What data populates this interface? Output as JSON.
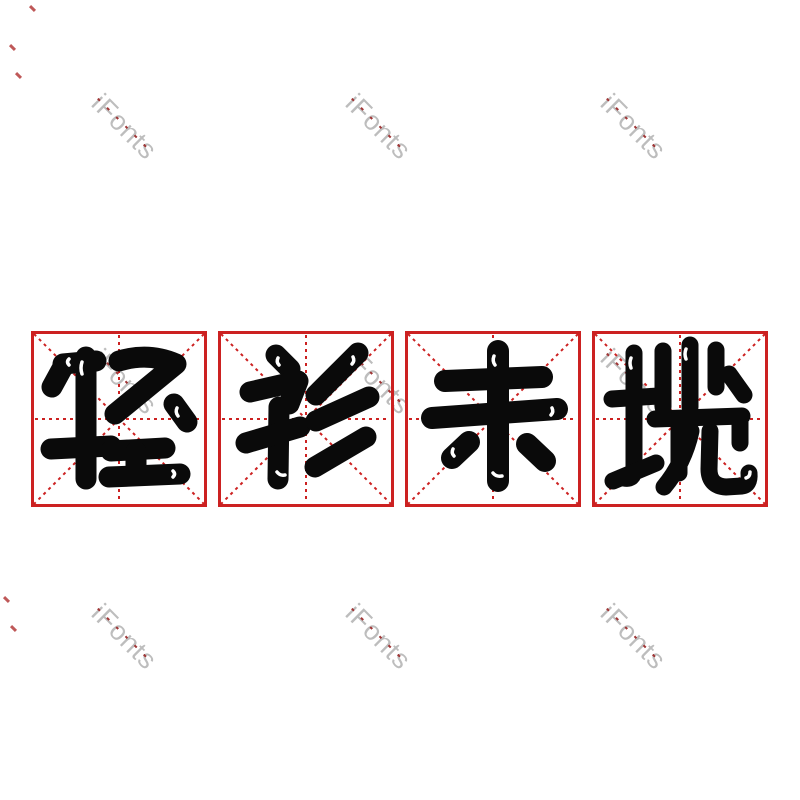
{
  "canvas": {
    "width": 800,
    "height": 800,
    "background": "#ffffff"
  },
  "phrase": {
    "text": "轻衫未揽"
  },
  "cells": [
    {
      "char": "轻"
    },
    {
      "char": "衫"
    },
    {
      "char": "未"
    },
    {
      "char": "揽"
    }
  ],
  "grid": {
    "color": "#cc2121",
    "border_width": 3,
    "line_width": 2,
    "dash": "3 4",
    "size": 176,
    "top": 331,
    "lefts": [
      31,
      218,
      405,
      592
    ]
  },
  "glyph_style": {
    "color": "#0a0a0a",
    "highlight_color": "#ffffff",
    "highlight_width": 3.5
  },
  "glyphs": {
    "轻": {
      "stroke_width": 21,
      "strokes": [
        "M 32,33 L 65,30",
        "M 33,34 L 21,56",
        "M 55,26 L 55,148",
        "M 20,118 L 80,115",
        "M 88,30 Q 118,21 145,33 L 84,83",
        "M 143,73 L 156,91",
        "M 80,120 L 134,117",
        "M 105,121 L 105,144",
        "M 78,146 L 149,143"
      ],
      "highlights": [
        "M 38,28 Q 35,31 38,34",
        "M 51,31 Q 49,37 51,43",
        "M 146,77 Q 144,81 147,85",
        "M 142,140 Q 145,143 142,146"
      ]
    },
    "衫": {
      "stroke_width": 21,
      "strokes": [
        "M 58,24 L 72,38",
        "M 32,61 L 80,50 L 71,73",
        "M 61,76 L 60,148",
        "M 82,96 L 28,112",
        "M 140,22 L 98,64",
        "M 151,66 L 98,90",
        "M 148,106 L 97,136"
      ],
      "highlights": [
        "M 60,27 Q 58,31 61,34",
        "M 59,141 Q 62,145 67,144",
        "M 135,26 Q 137,30 134,33"
      ]
    },
    "未": {
      "stroke_width": 22,
      "strokes": [
        "M 40,50 L 137,46",
        "M 27,87 L 152,78",
        "M 93,20 L 93,150",
        "M 64,111 L 47,127",
        "M 122,113 L 140,130"
      ],
      "highlights": [
        "M 89,25 Q 87,30 90,34",
        "M 88,142 Q 91,146 97,145",
        "M 49,125 Q 46,122 48,118",
        "M 147,77 Q 149,81 146,84"
      ]
    },
    "揽": {
      "stroke_width": 17,
      "strokes": [
        "M 42,22 L 42,138 Q 42,149 32,147",
        "M 20,68 L 66,65",
        "M 21,150 L 64,132",
        "M 71,20 L 71,76",
        "M 98,14 L 98,76",
        "M 124,19 L 124,56",
        "M 137,43 L 152,64",
        "M 63,88 L 150,85",
        "M 87,98 L 87,142",
        "M 148,86 L 148,112",
        "M 99,100 Q 92,132 72,156",
        "M 118,100 L 117,138 Q 117,155 134,156 L 150,155 Q 158,154 157,142"
      ],
      "highlights": [
        "M 39,27 Q 37,32 39,37",
        "M 154,147 Q 158,146 158,141",
        "M 94,18 Q 92,23 94,28"
      ]
    }
  },
  "watermark": {
    "text": "iFonts",
    "color": "#bdbdbd",
    "dash_color": "#a03636",
    "font_size": 27,
    "rotation_deg": 45,
    "positions": [
      {
        "x": 107,
        "y": 88
      },
      {
        "x": 361,
        "y": 88
      },
      {
        "x": 616,
        "y": 88
      },
      {
        "x": 107,
        "y": 343
      },
      {
        "x": 361,
        "y": 343
      },
      {
        "x": 616,
        "y": 343
      },
      {
        "x": 107,
        "y": 598
      },
      {
        "x": 361,
        "y": 598
      },
      {
        "x": 616,
        "y": 598
      }
    ]
  },
  "stray_marks": {
    "color": "#b43b3b",
    "positions": [
      {
        "x": 29,
        "y": 7
      },
      {
        "x": 9,
        "y": 46
      },
      {
        "x": 15,
        "y": 74
      },
      {
        "x": 3,
        "y": 598
      },
      {
        "x": 10,
        "y": 627
      }
    ]
  }
}
